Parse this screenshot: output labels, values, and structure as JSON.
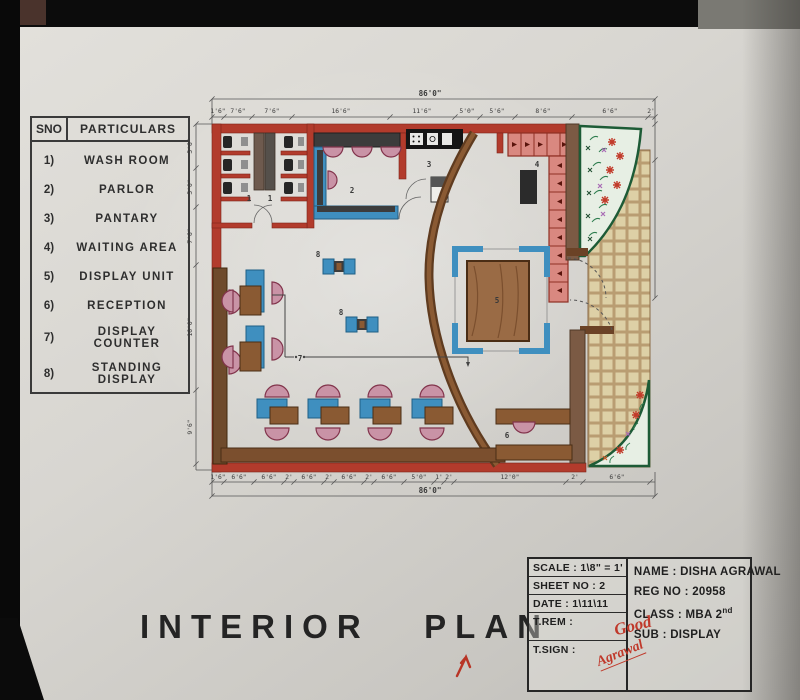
{
  "title": "INTERIOR   PLAN",
  "legend": {
    "header_sno": "SNO",
    "header_particulars": "PARTICULARS",
    "items": [
      {
        "no": "1)",
        "label": "WASH ROOM"
      },
      {
        "no": "2)",
        "label": "PARLOR"
      },
      {
        "no": "3)",
        "label": "PANTARY"
      },
      {
        "no": "4)",
        "label": "WAITING AREA"
      },
      {
        "no": "5)",
        "label": "DISPLAY UNIT"
      },
      {
        "no": "6)",
        "label": "RECEPTION"
      },
      {
        "no": "7)",
        "label": "DISPLAY COUNTER"
      },
      {
        "no": "8)",
        "label": "STANDING DISPLAY"
      }
    ]
  },
  "title_block": {
    "scale": "SCALE : 1\\8\" = 1'",
    "sheet": "SHEET NO : 2",
    "date": "DATE : 1\\11\\11",
    "t_rem": "T.REM :",
    "t_sign": "T.SIGN :",
    "remark_handwritten": "Good",
    "signature_handwritten": "Agrawal",
    "name": "NAME : DISHA AGRAWAL",
    "reg_no": "REG NO : 20958",
    "class_main": "CLASS : MBA 2",
    "class_sup": "nd",
    "subject": "SUB : DISPLAY"
  },
  "plan": {
    "room_numbers": {
      "washroom_a": "1",
      "washroom_b": "1",
      "parlor": "2",
      "pantry": "3",
      "waiting": "4",
      "display_unit": "5",
      "reception": "6",
      "display_counter": "7",
      "standing_display_a": "8",
      "standing_display_b": "8"
    },
    "dimensions": {
      "overall_top": "86'0\"",
      "overall_bottom": "86'0\"",
      "top_segments": [
        "1'6\"",
        "7'6\"",
        "7'6\"",
        "16'6\"",
        "11'6\"",
        "5'0\"",
        "5'6\"",
        "8'6\"",
        "6'6\"",
        "2'"
      ],
      "bottom_segments": [
        "1'6\"",
        "6'6\"",
        "6'6\"",
        "2'",
        "6'6\"",
        "2'",
        "6'6\"",
        "2'",
        "6'6\"",
        "5'0\"",
        "1'",
        "2'",
        "12'0\"",
        "2'",
        "6'6\""
      ],
      "left_segments": [
        "5'6\"",
        "5'0\"",
        "7'6\"",
        "16'0\"",
        "9'6\""
      ]
    }
  },
  "colors": {
    "wall_red": "#b23b2c",
    "wood_brown": "#7b4f2e",
    "counter_blue": "#3f8fbf",
    "chair_pink": "#c993a6",
    "planter_green": "#1d5b36",
    "tile_tan": "#ddd0a6"
  }
}
